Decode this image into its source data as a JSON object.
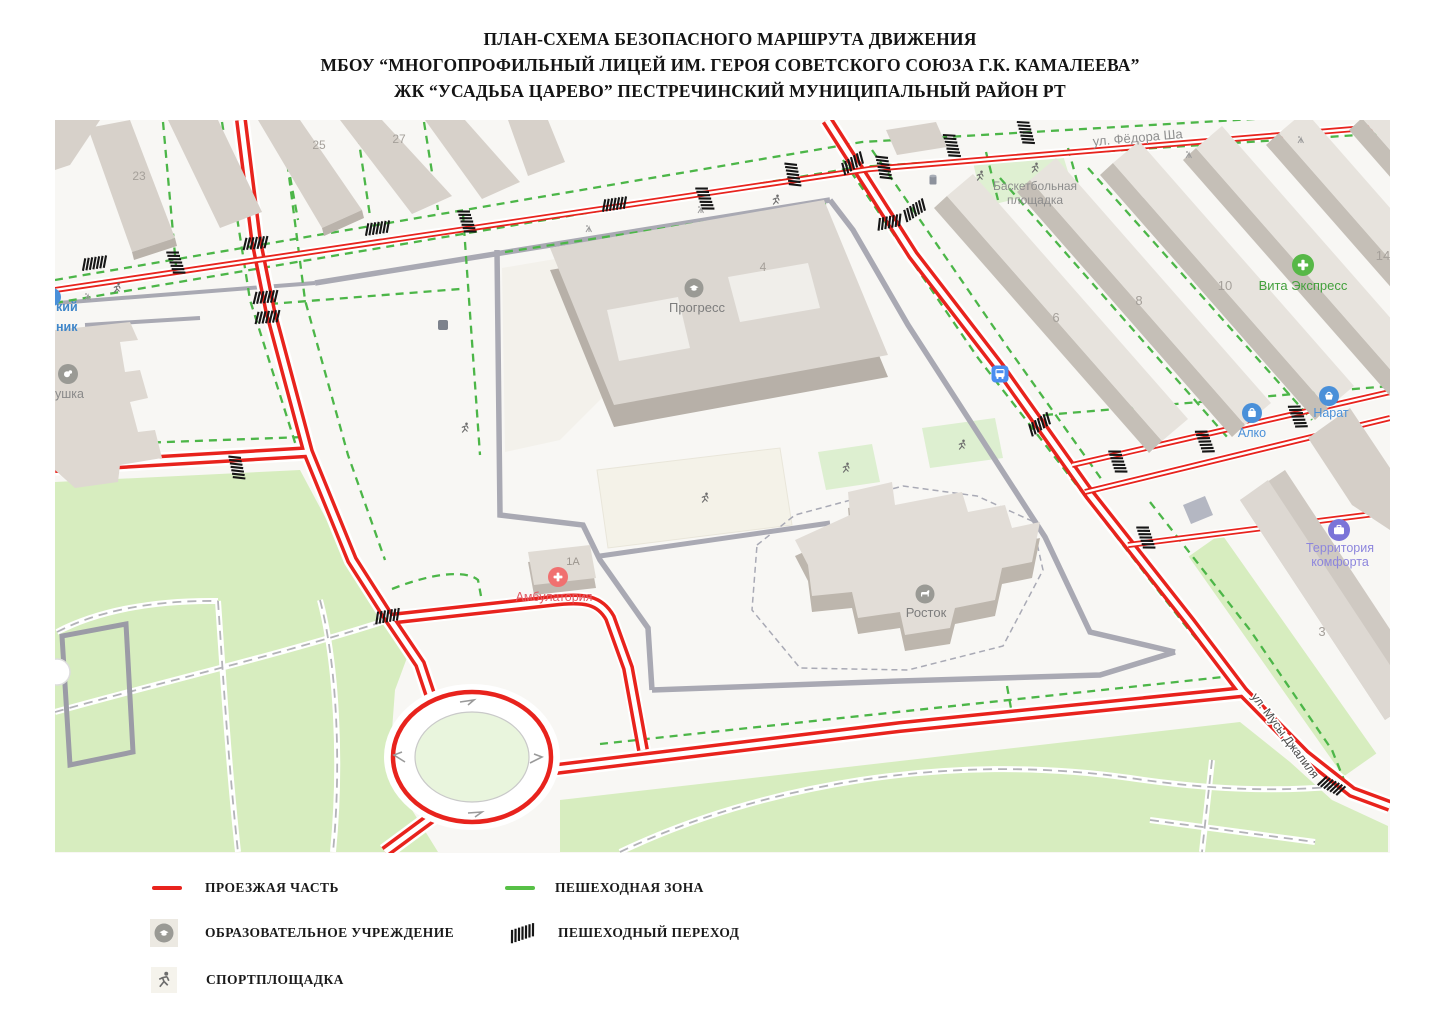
{
  "title": {
    "line1": "ПЛАН-СХЕМА БЕЗОПАСНОГО МАРШРУТА ДВИЖЕНИЯ",
    "line2": "МБОУ “МНОГОПРОФИЛЬНЫЙ ЛИЦЕЙ ИМ. ГЕРОЯ СОВЕТСКОГО СОЮЗА Г.К. КАМАЛЕЕВА”",
    "line3": "ЖК “УСАДЬБА ЦАРЕВО” ПЕСТРЕЧИНСКИЙ МУНИЦИПАЛЬНЫЙ РАЙОН РТ"
  },
  "map": {
    "streets": {
      "fedora": "ул. Фёдора Ша",
      "musa": "ул. Мусы Джалиля"
    },
    "labels": {
      "progress": "Прогресс",
      "school_num": "4",
      "rostok": "Росток",
      "ambulatoria": "Амбулатория",
      "ambulatoria_num": "1А",
      "basketball1": "Баскетбольная",
      "basketball2": "площадка",
      "vita": "Вита Экспресс",
      "alko": "Алко",
      "narat": "Нарат",
      "territory1": "Территория",
      "territory2": "комфорта",
      "partial_kiy": "кий",
      "partial_nik": "ник",
      "partial_ushka": "ушка",
      "b23": "23",
      "b25": "25",
      "b27": "27",
      "b6": "6",
      "b8": "8",
      "b10": "10",
      "b14": "14",
      "b3": "3"
    },
    "colors": {
      "route_red": "#e8231d",
      "pedestrian_green": "#4cb648",
      "park_green": "#d7edbf",
      "building_grey": "#dcd6cf"
    }
  },
  "legend": {
    "roadway": "ПРОЕЗЖАЯ ЧАСТЬ",
    "education": "ОБРАЗОВАТЕЛЬНОЕ УЧРЕЖДЕНИЕ",
    "sport": "СПОРТПЛОЩАДКА",
    "ped_zone": "ПЕШЕХОДНАЯ ЗОНА",
    "ped_crossing": "ПЕШЕХОДНЫЙ ПЕРЕХОД"
  }
}
